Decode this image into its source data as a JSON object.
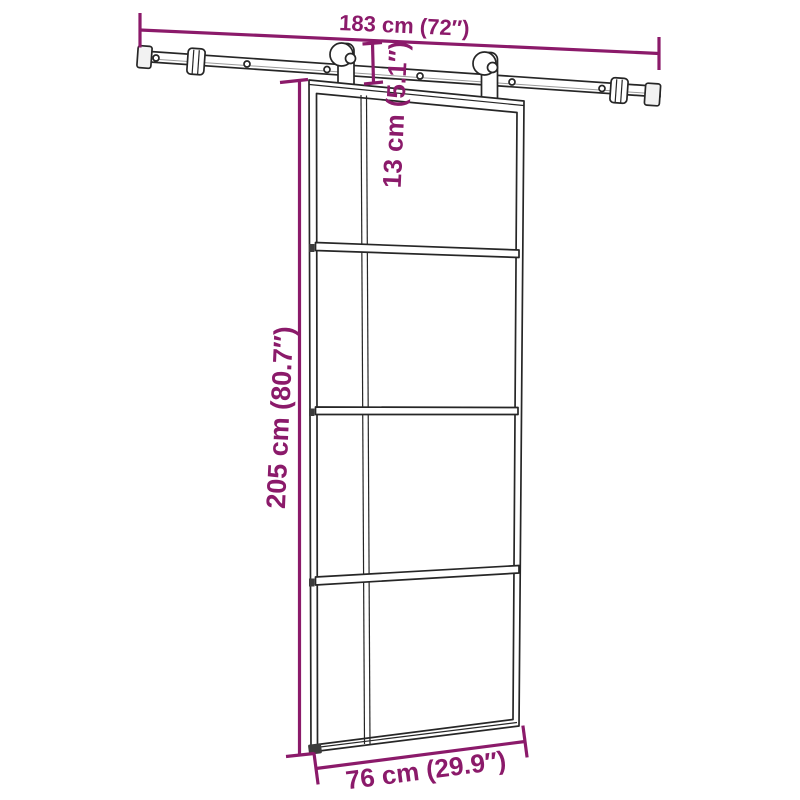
{
  "theme": {
    "background": "#ffffff",
    "dimension-color": "#8b1a6a",
    "line-color": "#262626"
  },
  "diagram": {
    "dimensions": {
      "rail_width": {
        "label": "183 cm (72″)",
        "cm": 183,
        "inches": 72
      },
      "door_height": {
        "label": "205 cm (80.7″)",
        "cm": 205,
        "inches": 80.7
      },
      "door_width": {
        "label": "76 cm (29.9″)",
        "cm": 76,
        "inches": 29.9
      },
      "hanger_height": {
        "label": "13 cm (5.1″)",
        "cm": 13,
        "inches": 5.1
      }
    }
  }
}
